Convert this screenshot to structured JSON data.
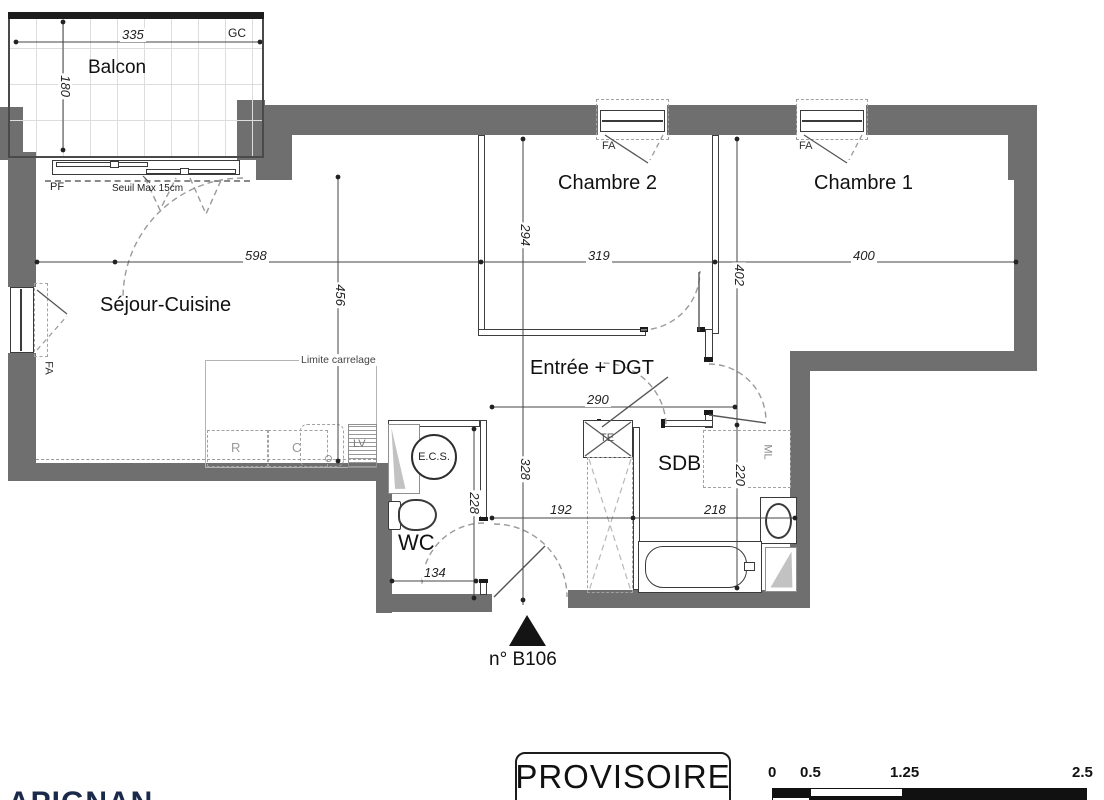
{
  "plan": {
    "rooms": {
      "balcon": "Balcon",
      "sejour": "Séjour-Cuisine",
      "chambre2": "Chambre 2",
      "chambre1": "Chambre 1",
      "entree": "Entrée + DGT",
      "sdb": "SDB",
      "wc": "WC"
    },
    "dims": {
      "balcon_width": "335",
      "balcon_depth": "180",
      "sejour_width": "598",
      "sejour_depth": "456",
      "chambre2_width": "319",
      "chambre2_depth": "294",
      "chambre1_width": "400",
      "chambre1_depth": "402",
      "degagement_width": "290",
      "degagement_depth": "328",
      "wc_depth": "228",
      "wc_width": "134",
      "entree_width": "192",
      "sdb_width": "218",
      "sdb_depth": "220"
    },
    "annotations": {
      "gc": "GC",
      "pf": "PF",
      "fa": "FA",
      "seuil": "Seuil Max 15cm",
      "limite_carrelage": "Limite carrelage",
      "kitchen_r": "R",
      "kitchen_c": "C",
      "kitchen_lv": "LV",
      "te": "TE",
      "ml": "ML",
      "ecs": "E.C.S.",
      "unit_number": "n° B106"
    },
    "stamp": "PROVISOIRE",
    "scale": {
      "labels": [
        "0",
        "0.5",
        "1.25",
        "2.5"
      ]
    },
    "footer_fragment": "APIGNAN",
    "colors": {
      "wall": "#6f6f6f",
      "line": "#3e3e3e",
      "dashed": "#9a9a9a",
      "footer_text": "#1b2a4a"
    }
  }
}
